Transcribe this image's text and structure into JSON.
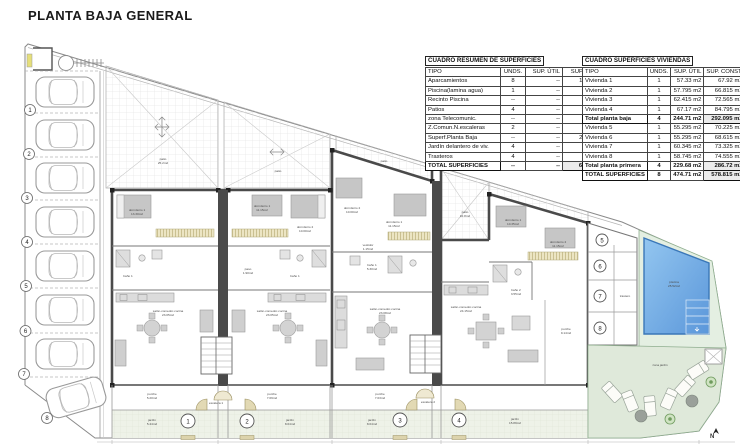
{
  "title": "PLANTA BAJA GENERAL",
  "tables": {
    "resumen": {
      "title": "CUADRO RESUMEN DE SUPERFICIES",
      "headers": [
        "TIPO",
        "UNDS.",
        "SUP. ÚTIL",
        "SUP. CONST."
      ],
      "rows": [
        [
          "Aparcamientos",
          "8",
          "--",
          "105.91 m2"
        ],
        [
          "Piscina(lamina agua)",
          "1",
          "--",
          "25.52 m2"
        ],
        [
          "Recinto Piscina",
          "--",
          "--",
          "42.78 m2"
        ],
        [
          "Patios",
          "4",
          "--",
          "76.22 m2"
        ],
        [
          "zona Telecomunic.",
          "--",
          "--",
          "4.74 m2"
        ],
        [
          "Z.Comun.N.escaleras",
          "2",
          "--",
          "9.30 m2"
        ],
        [
          "Superf.Planta Baja",
          "--",
          "--",
          "277.30 m2"
        ],
        [
          "Jardín delantero de viv.",
          "4",
          "--",
          "68.04 m2"
        ],
        [
          "Trasteros",
          "4",
          "--",
          "12.85 m2"
        ],
        [
          "TOTAL SUPERFICIES",
          "--",
          "--",
          "622.66 m2"
        ]
      ],
      "total_rows": [
        9
      ]
    },
    "viviendas": {
      "title": "CUADRO SUPERFICIES VIVIENDAS",
      "headers": [
        "TIPO",
        "UNDS.",
        "SUP. ÚTIL",
        "SUP. CONST."
      ],
      "rows": [
        [
          "Vivienda 1",
          "1",
          "57.33 m2",
          "67.92 m2"
        ],
        [
          "Vivienda 2",
          "1",
          "57.795 m2",
          "66.815 m2"
        ],
        [
          "Vivienda 3",
          "1",
          "62.415 m2",
          "72.565 m2"
        ],
        [
          "Vivienda 4",
          "1",
          "67.17 m2",
          "84.795 m2"
        ],
        [
          "Total planta baja",
          "4",
          "244.71 m2",
          "292.095 m2"
        ],
        [
          "Vivienda 5",
          "1",
          "55.295 m2",
          "70.225 m2"
        ],
        [
          "Vivienda 6",
          "1",
          "55.295 m2",
          "68.615 m2"
        ],
        [
          "Vivienda 7",
          "1",
          "60.345 m2",
          "73.325 m2"
        ],
        [
          "Vivienda 8",
          "1",
          "58.745 m2",
          "74.555 m2"
        ],
        [
          "Total planta primera",
          "4",
          "229.68 m2",
          "286.72 m2"
        ],
        [
          "TOTAL SUPERFICIES",
          "8",
          "474.71 m2",
          "578.815 m2"
        ]
      ],
      "total_rows": [
        4,
        9,
        10
      ]
    }
  },
  "plan": {
    "parking_numbers": [
      "1",
      "2",
      "3",
      "4",
      "5",
      "6",
      "7",
      "8"
    ],
    "entrance_numbers": [
      "1",
      "2",
      "3",
      "4"
    ],
    "storage_numbers": [
      "5",
      "6",
      "7",
      "8"
    ],
    "colors": {
      "pool_blue": "#5b97da",
      "garden_green": "#dfe9da",
      "wall_dark": "#444444"
    },
    "labels": {
      "patio1": "patio",
      "patio1_area": "25.2m2",
      "patio2": "patio",
      "patio3": "patio",
      "piscina": "piscina",
      "piscina_area": "25.52m2",
      "zona_jardin": "zona jardín",
      "trastero": "trastero",
      "escalera1": "escalera 1",
      "escalera2": "escalera 2",
      "north": "N"
    },
    "units": [
      {
        "dorm1": "dormitorio 1",
        "dorm1_area": "13.30m2",
        "salon": "salón-comedor-cocina",
        "salon_area": "23.05m2",
        "porche": "porche",
        "porche_area": "5.20m2",
        "jardin": "jardín",
        "jardin_area": "5.44m2",
        "bath": "baño 1"
      },
      {
        "dorm1": "dormitorio 1",
        "dorm1_area": "11.15m2",
        "dorm2": "dormitorio 2",
        "dorm2_area": "10.00m2",
        "salon": "salón-comedor-cocina",
        "salon_area": "23.05m2",
        "porche": "porche",
        "porche_area": "7.09m2",
        "jardin": "jardín",
        "jardin_area": "8.04m2",
        "bath": "baño 1",
        "paso": "paso",
        "paso_area": "1.90m2"
      },
      {
        "dorm1": "dormitorio 1",
        "dorm1_area": "11.15m2",
        "dorm2": "dormitorio 2",
        "dorm2_area": "10.00m2",
        "salon": "salón-comedor-cocina",
        "salon_area": "23.08m2",
        "porche": "porche",
        "porche_area": "7.03m2",
        "jardin": "jardín",
        "jardin_area": "8.04m2",
        "bath": "baño 1",
        "bath_area": "5.30m2",
        "vestidor": "vestidor",
        "vestidor_area": "1.15m2"
      },
      {
        "dorm1": "dormitorio 1",
        "dorm1_area": "10.35m2",
        "dorm2": "dormitorio 2",
        "dorm2_area": "11.15m2",
        "salon": "salón-comedor-cocina",
        "salon_area": "24.15m2",
        "porche": "porche",
        "porche_area": "9.14m2",
        "jardin": "jardín",
        "jardin_area": "15.89m2",
        "bath": "baño 2",
        "bath_area": "3.55m2",
        "patio": "patio",
        "patio_area": "10.8m2"
      }
    ]
  }
}
